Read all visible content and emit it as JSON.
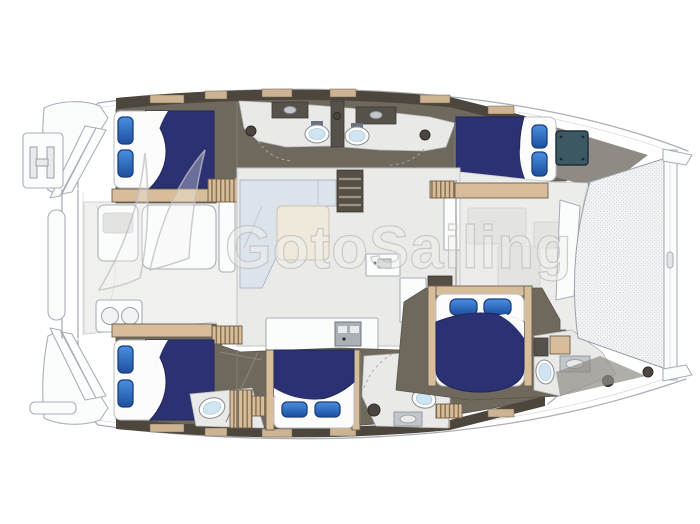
{
  "watermark": {
    "text": "GotoSailing",
    "logo": "sail-swoosh-mark"
  },
  "colors": {
    "hull_outline": "#a9afb7",
    "hull_fill": "#ffffff",
    "interior_floor_dark": "#6e685d",
    "side_locker_dark": "#4d463d",
    "wood_trim": "#d8bd9a",
    "bed_blanket_navy": "#2b3172",
    "pillow_blue": "#2f72cf",
    "pillow_border": "#1b3e7e",
    "mattress_white": "#fcfcfc",
    "bathroom_floor": "#e9eae8",
    "toilet_seat_blue": "#cfe6f2",
    "saloon_floor": "#eaeae8",
    "sofa_gray_blue": "#dde3ea",
    "table_beige": "#efe9dc",
    "stair_dark": "#564f45",
    "counter_dark": "#57514b",
    "hatch_teal": "#3c5862",
    "deck_wedge_gray": "#8f8b84",
    "watermark_gray": "#c2c2c0"
  },
  "diagram": {
    "type": "yacht-floorplan",
    "vessel": "sailing-catamaran",
    "view": "top-down-interior-layout",
    "orientation": {
      "bow": "right",
      "stern": "left"
    },
    "rooms": [
      {
        "id": "swim-platform-top",
        "fixtures": [
          "boarding-steps",
          "boarding-ladder"
        ]
      },
      {
        "id": "swim-platform-bottom",
        "fixtures": [
          "boarding-steps",
          "step-rail"
        ]
      },
      {
        "id": "cockpit-aft",
        "fixtures": [
          "cockpit-table",
          "bench-seat",
          "side-seat",
          "wet-bar-grill"
        ]
      },
      {
        "id": "saloon",
        "fixtures": [
          "l-shaped-sofa",
          "coffee-table",
          "companionway-stairs"
        ]
      },
      {
        "id": "galley",
        "fixtures": [
          "island-counter",
          "twin-sink",
          "worktop",
          "tall-cabinet"
        ]
      },
      {
        "id": "cabin-aft-top",
        "fixtures": [
          "double-bed",
          "two-pillows",
          "shelf"
        ]
      },
      {
        "id": "head-top-left",
        "fixtures": [
          "toilet",
          "sink",
          "shower"
        ]
      },
      {
        "id": "head-top-right",
        "fixtures": [
          "toilet",
          "sink",
          "shower"
        ]
      },
      {
        "id": "cabin-fwd-top",
        "fixtures": [
          "double-bed",
          "two-pillows",
          "deck-hatch"
        ]
      },
      {
        "id": "cabin-aft-bottom",
        "fixtures": [
          "double-bed",
          "two-pillows",
          "toilet"
        ]
      },
      {
        "id": "cabin-mid-bottom",
        "fixtures": [
          "double-bed",
          "two-pillows"
        ]
      },
      {
        "id": "head-bottom",
        "fixtures": [
          "toilet",
          "sink",
          "shower"
        ]
      },
      {
        "id": "cabin-forward",
        "fixtures": [
          "double-bed",
          "two-pillows"
        ]
      },
      {
        "id": "head-forward",
        "fixtures": [
          "toilet",
          "sink",
          "shower-drain"
        ]
      },
      {
        "id": "forward-lounge",
        "fixtures": [
          "storage-shelf",
          "settee"
        ]
      },
      {
        "id": "trampoline",
        "fixtures": [
          "mesh-net",
          "bow-crossbeam"
        ]
      }
    ],
    "fixture_counts": {
      "double_beds": 5,
      "toilets": 5,
      "heads": 4,
      "tables": 2
    }
  }
}
